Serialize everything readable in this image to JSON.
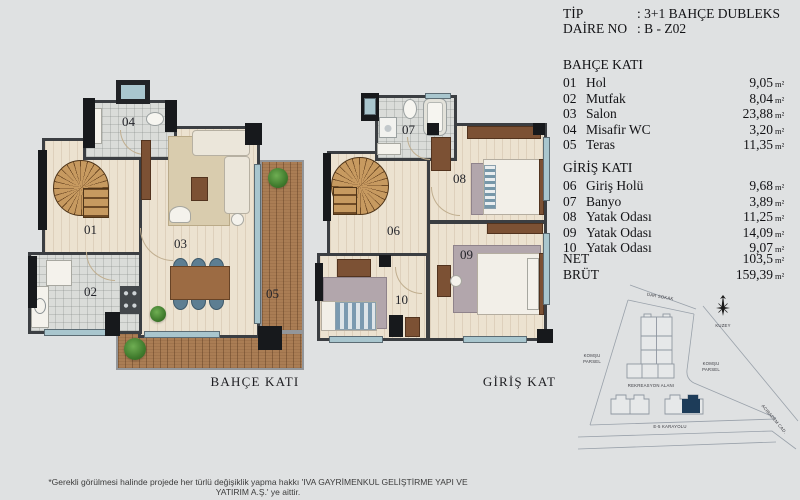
{
  "unit": "m²",
  "header": {
    "tip_label": "TİP",
    "tip_value": ": 3+1 BAHÇE DUBLEKS",
    "daire_label": "DAİRE NO",
    "daire_value": ": B - Z02"
  },
  "bahce_kati": {
    "title": "BAHÇE KATI",
    "rooms": [
      {
        "no": "01",
        "name": "Hol",
        "area": "9,05"
      },
      {
        "no": "02",
        "name": "Mutfak",
        "area": "8,04"
      },
      {
        "no": "03",
        "name": "Salon",
        "area": "23,88"
      },
      {
        "no": "04",
        "name": "Misafir WC",
        "area": "3,20"
      },
      {
        "no": "05",
        "name": "Teras",
        "area": "11,35"
      }
    ]
  },
  "giris_kati": {
    "title": "GİRİŞ KATI",
    "rooms": [
      {
        "no": "06",
        "name": "Giriş Holü",
        "area": "9,68"
      },
      {
        "no": "07",
        "name": "Banyo",
        "area": "3,89"
      },
      {
        "no": "08",
        "name": "Yatak Odası",
        "area": "11,25"
      },
      {
        "no": "09",
        "name": "Yatak Odası",
        "area": "14,09"
      },
      {
        "no": "10",
        "name": "Yatak Odası",
        "area": "9,07"
      }
    ]
  },
  "totals": {
    "net_label": "NET",
    "net_value": "103,5",
    "brut_label": "BRÜT",
    "brut_value": "159,39"
  },
  "plan_captions": {
    "left": "BAHÇE KATI",
    "right": "GİRİŞ KAT"
  },
  "site_plan": {
    "street_top": "DAR SOKAK",
    "north": "KUZEY",
    "neighbor_line1": "KOMŞU",
    "neighbor_line2": "PARSEL",
    "recreation": "REKREASYON ALANI",
    "highway": "E-5 KARAYOLU",
    "avenue": "ACIBADEM CAD.",
    "highlight_color": "#1d3c59"
  },
  "footer": {
    "text": "*Gerekli görülmesi halinde projede her türlü değişiklik yapma hakkı 'IVA GAYRİMENKUL GELİŞTİRME YAPI VE YATIRIM A.Ş.' ye aittir."
  }
}
